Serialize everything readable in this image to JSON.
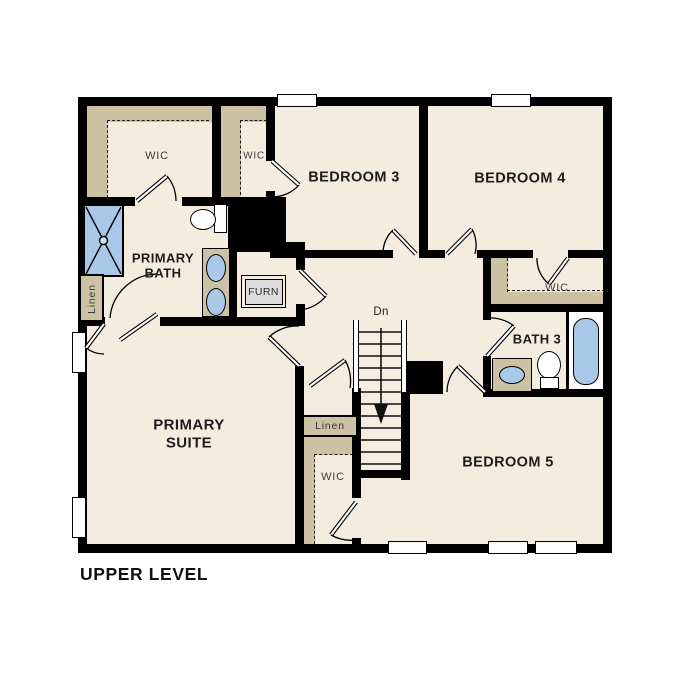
{
  "title": "UPPER LEVEL",
  "colors": {
    "floor": "#f4ecdf",
    "attic_tan": "#cdc1a4",
    "fixture_blue": "#a9c8e8",
    "wall_black": "#000000",
    "furnace_gray": "#dcdcdc"
  },
  "labels": {
    "primary_wic": "WIC",
    "bed3_wic": "WIC",
    "bedroom3": "BEDROOM 3",
    "bedroom4": "BEDROOM 4",
    "primary_bath": "PRIMARY BATH",
    "linen_primary": "Linen",
    "furnace": "FURN",
    "stairs_down": "Dn",
    "bedroom4_wic": "WIC",
    "bath3": "BATH 3",
    "primary_suite": "PRIMARY SUITE",
    "linen_hall": "Linen",
    "hall_wic": "WIC",
    "bedroom5": "BEDROOM 5"
  }
}
